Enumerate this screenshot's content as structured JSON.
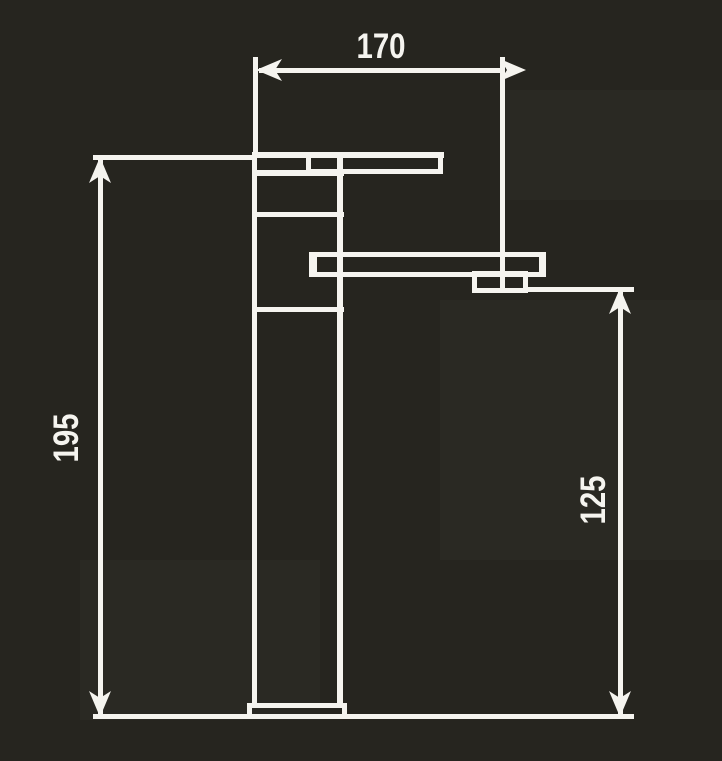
{
  "drawing": {
    "subject": "single-lever tall basin mixer tap, dimensioned side elevation",
    "background_color": "#26251f",
    "line_color": "#f5f4ef",
    "dimensions": {
      "width": {
        "label": "170",
        "orientation": "horizontal",
        "position": "top"
      },
      "total_height": {
        "label": "195",
        "orientation": "vertical",
        "position": "left"
      },
      "outlet_height": {
        "label": "125",
        "orientation": "vertical",
        "position": "right"
      }
    }
  }
}
